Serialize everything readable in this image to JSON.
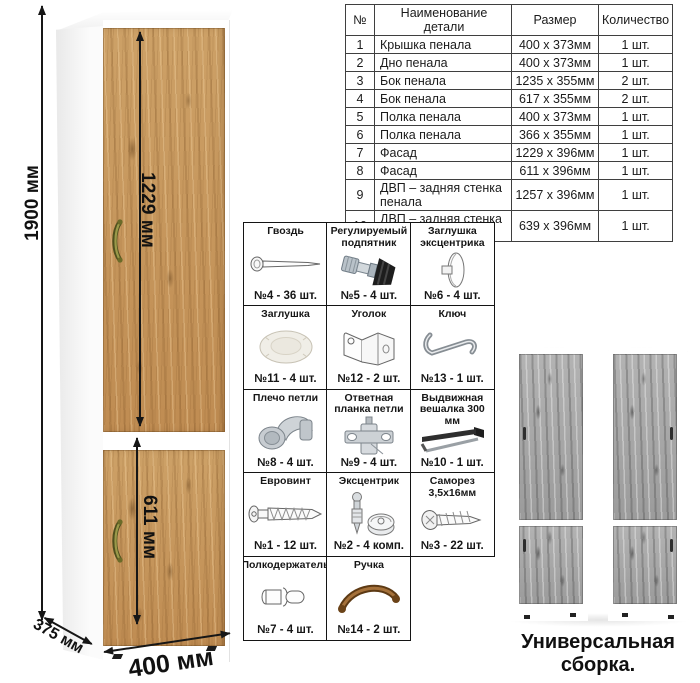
{
  "illustration": {
    "dim_height": "1900 мм",
    "dim_upper_door": "1229 мм",
    "dim_lower_door": "611 мм",
    "dim_depth": "375 мм",
    "dim_width": "400 мм"
  },
  "parts_table": {
    "headers": {
      "num": "№",
      "name": "Наименование детали",
      "size": "Размер",
      "qty": "Количество"
    },
    "rows": [
      {
        "num": "1",
        "name": "Крышка пенала",
        "size": "400 х 373мм",
        "qty": "1 шт."
      },
      {
        "num": "2",
        "name": "Дно пенала",
        "size": "400 х 373мм",
        "qty": "1 шт."
      },
      {
        "num": "3",
        "name": "Бок пенала",
        "size": "1235 х 355мм",
        "qty": "2 шт."
      },
      {
        "num": "4",
        "name": "Бок пенала",
        "size": "617 х 355мм",
        "qty": "2 шт."
      },
      {
        "num": "5",
        "name": "Полка пенала",
        "size": "400 х 373мм",
        "qty": "1 шт."
      },
      {
        "num": "6",
        "name": "Полка пенала",
        "size": "366 х 355мм",
        "qty": "1 шт."
      },
      {
        "num": "7",
        "name": "Фасад",
        "size": "1229 х 396мм",
        "qty": "1 шт."
      },
      {
        "num": "8",
        "name": "Фасад",
        "size": "611 х 396мм",
        "qty": "1 шт."
      },
      {
        "num": "9",
        "name": "ДВП – задняя стенка пенала",
        "size": "1257 х 396мм",
        "qty": "1 шт."
      },
      {
        "num": "10",
        "name": "ДВП – задняя стенка пенала",
        "size": "639 х 396мм",
        "qty": "1 шт."
      }
    ]
  },
  "hardware_grid": {
    "cells": [
      {
        "name": "Гвоздь",
        "count": "№4 - 36 шт.",
        "icon": "nail-icon"
      },
      {
        "name": "Регулируемый подпятник",
        "count": "№5 - 4 шт.",
        "icon": "adjustable-foot-icon"
      },
      {
        "name": "Заглушка эксцентрика",
        "count": "№6 - 4 шт.",
        "icon": "cam-cover-icon"
      },
      {
        "name": "Заглушка",
        "count": "№11 - 4 шт.",
        "icon": "cover-cap-icon"
      },
      {
        "name": "Уголок",
        "count": "№12 - 2 шт.",
        "icon": "corner-bracket-icon"
      },
      {
        "name": "Ключ",
        "count": "№13 - 1 шт.",
        "icon": "hex-key-icon"
      },
      {
        "name": "Плечо петли",
        "count": "№8 - 4 шт.",
        "icon": "hinge-arm-icon"
      },
      {
        "name": "Ответная планка петли",
        "count": "№9 - 4 шт.",
        "icon": "hinge-plate-icon"
      },
      {
        "name": "Выдвижная вешалка 300 мм",
        "count": "№10 - 1 шт.",
        "icon": "pullout-hanger-icon"
      },
      {
        "name": "Евровинт",
        "count": "№1 - 12 шт.",
        "icon": "euro-screw-icon"
      },
      {
        "name": "Эксцентрик",
        "count": "№2 - 4 комп.",
        "icon": "cam-lock-icon"
      },
      {
        "name": "Саморез 3,5х16мм",
        "count": "№3 - 22 шт.",
        "icon": "self-tapping-screw-icon"
      },
      {
        "name": "Полкодержатель",
        "count": "№7 - 4 шт.",
        "icon": "shelf-pin-icon"
      },
      {
        "name": "Ручка",
        "count": "№14 - 2 шт.",
        "icon": "handle-icon"
      }
    ]
  },
  "assembly": {
    "caption": "Универсальная сборка."
  },
  "colors": {
    "oak": "#c39056",
    "gray_wood": "#a6a6a6",
    "line": "#161616",
    "table_border": "#3f3f3f",
    "handle_bronze": "#7b6a2a",
    "handle_wood": "#8a5a28"
  }
}
